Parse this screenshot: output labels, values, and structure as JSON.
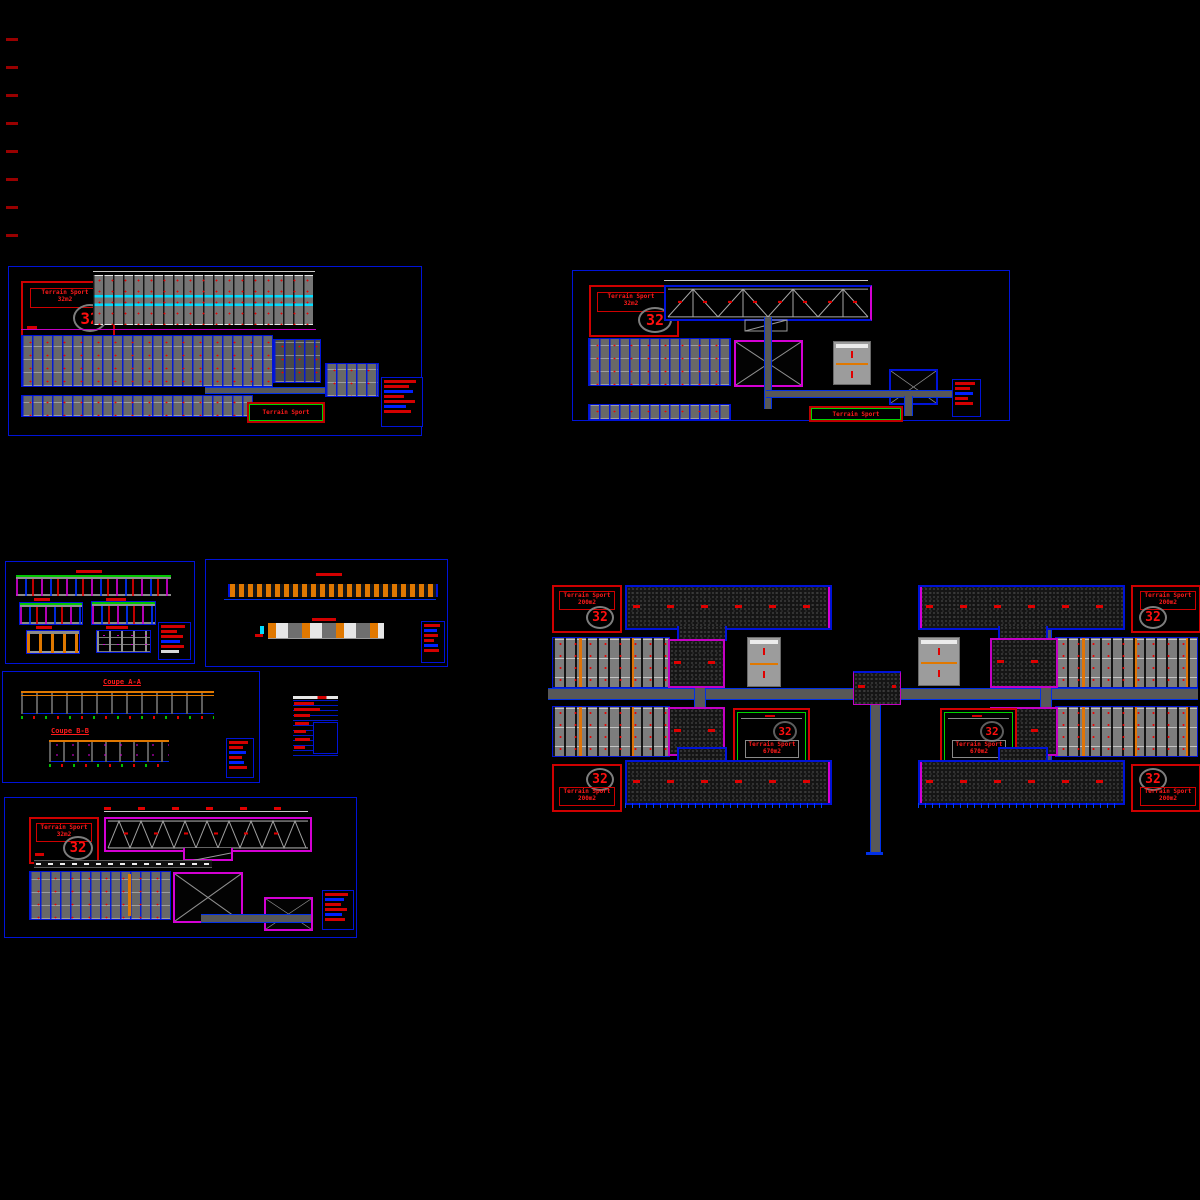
{
  "document": {
    "kind": "CAD drawing set - sports facility plans",
    "background": "#000000"
  },
  "colors": {
    "frame_blue": "#0013d8",
    "annotation_red": "#d40000",
    "magenta": "#d400d4",
    "green": "#00d400",
    "cyan": "#00dcff",
    "orange": "#e07800",
    "wall_gray": "#7d7d7d"
  },
  "sheet_block": {
    "line1": "Terrain Sport",
    "line2": "32m2",
    "number": "32"
  },
  "corner_block": {
    "line1": "Terrain Sport",
    "line2": "200m2",
    "number": "32"
  },
  "sport_field": {
    "line1": "Terrain Sport",
    "line2": "670m2",
    "number": "32"
  },
  "green_box": {
    "label": "Terrain Sport"
  },
  "sections": {
    "a": "Coupe A-A",
    "b": "Coupe B-B"
  }
}
